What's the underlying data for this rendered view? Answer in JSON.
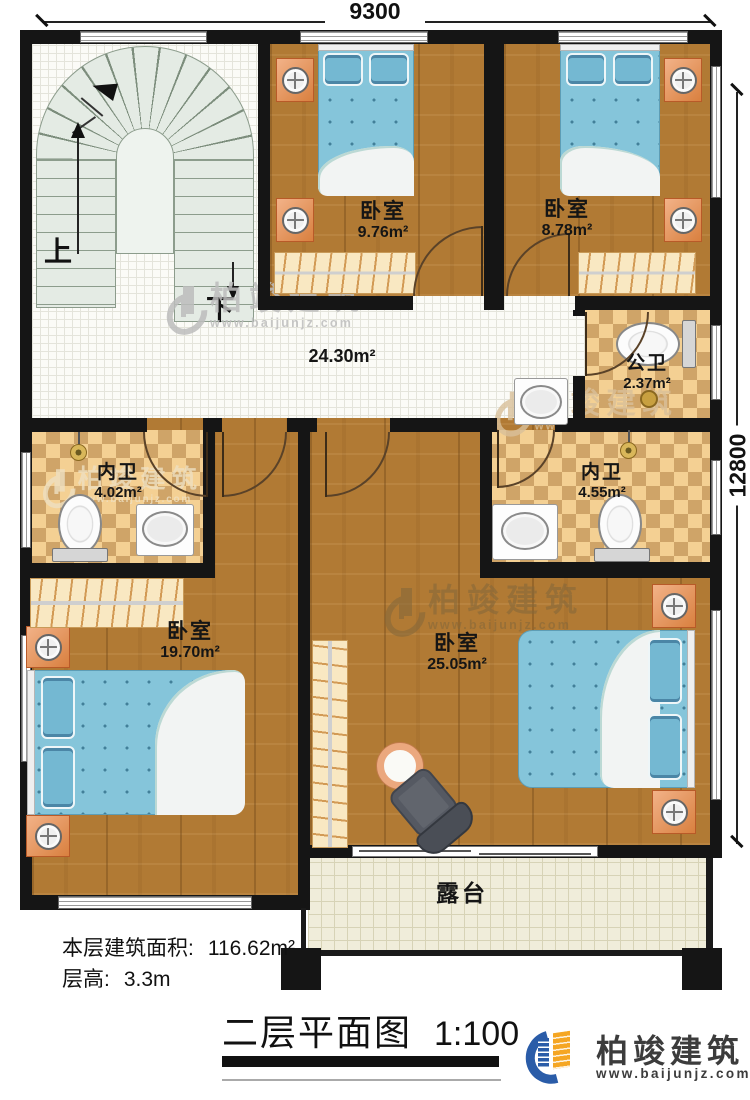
{
  "dims": {
    "top": "9300",
    "right": "12800"
  },
  "stairs": {
    "up": "上",
    "down": "下"
  },
  "hall": {
    "area": "24.30m²"
  },
  "rooms": [
    {
      "name": "卧室",
      "area": "9.76m²"
    },
    {
      "name": "卧室",
      "area": "8.78m²"
    },
    {
      "name": "公卫",
      "area": "2.37m²"
    },
    {
      "name": "内卫",
      "area": "4.02m²"
    },
    {
      "name": "内卫",
      "area": "4.55m²"
    },
    {
      "name": "卧室",
      "area": "19.70m²"
    },
    {
      "name": "卧室",
      "area": "25.05m²"
    }
  ],
  "terrace": {
    "label": "露台"
  },
  "footer": {
    "floor_area_label": "本层建筑面积:",
    "floor_area_value": "116.62m²",
    "floor_height_label": "层高:",
    "floor_height_value": "3.3m"
  },
  "title": {
    "text": "二层平面图",
    "scale": "1:100"
  },
  "brand": {
    "name": "柏竣建筑",
    "url": "www.baijunjz.com"
  },
  "watermark": {
    "name": "柏竣建筑",
    "url": "www.baijunjz.com"
  }
}
